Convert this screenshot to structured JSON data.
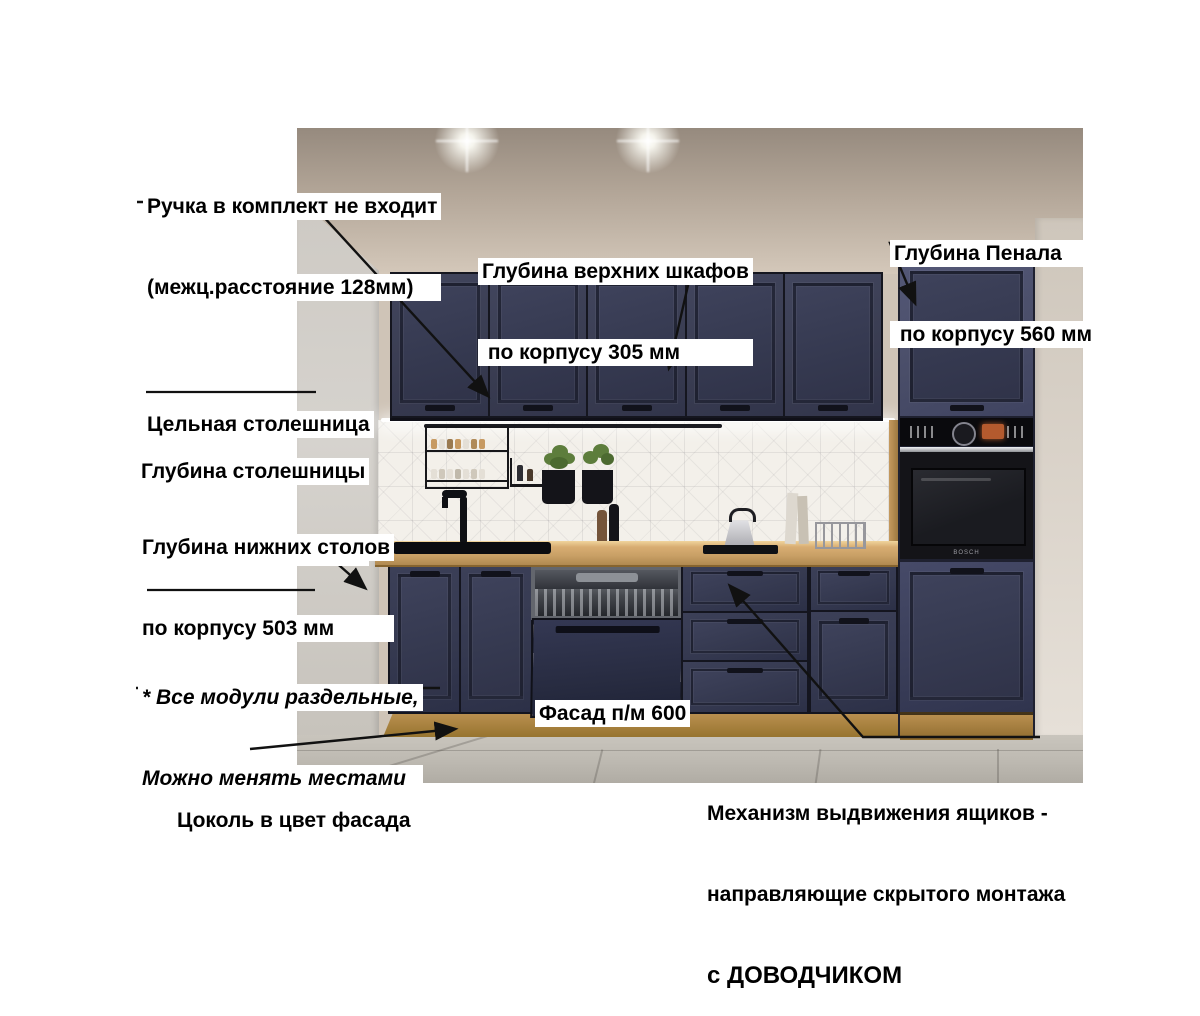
{
  "labels": {
    "handle_note": {
      "lines": [
        "Ручка в комплект не входит",
        "(межц.расстояние 128мм)"
      ]
    },
    "upper_depth": {
      "lines": [
        "Глубина верхних шкафов",
        " по корпусу 305 мм"
      ]
    },
    "penal_depth": {
      "lines": [
        "Глубина Пенала",
        " по корпусу 560 мм"
      ]
    },
    "solid_countertop": {
      "text": "Цельная столешница"
    },
    "countertop_depth": {
      "lines": [
        "Глубина столешницы",
        " 600 мм"
      ]
    },
    "base_depth": {
      "lines": [
        "Глубина нижних столов",
        "по корпусу 503 мм"
      ]
    },
    "modules_note": {
      "lines": [
        "* Все модули раздельные,",
        "Можно менять местами"
      ]
    },
    "plinth": {
      "text": "Цоколь в цвет фасада"
    },
    "dw_facade": {
      "text": "Фасад п/м 600"
    },
    "drawer_mech": {
      "lines": [
        "Механизм выдвижения ящиков -",
        "направляющие скрытого монтажа",
        "с ДОВОДЧИКОМ"
      ]
    }
  },
  "appliances": {
    "oven_brand": "BOSCH"
  },
  "colors": {
    "facade_navy": "#3a3d52",
    "facade_navy_dark": "#353950",
    "tall_navy": "#4a4e69",
    "countertop_wood": "#c9a066",
    "plinth_wood": "#b98f4f",
    "backsplash": "#f3f0ea",
    "wall_beige": "#b3a698",
    "wall_beige_dark": "#968a7e",
    "side_wall": "#d6d3ce",
    "floor_grey": "#bdb9b1",
    "oven_black": "#141418",
    "oven_black_panel": "#0a0a0d",
    "display_orange": "#b45a2e",
    "plant_green": "#5d7d3c",
    "annotation_line": "#111111"
  }
}
